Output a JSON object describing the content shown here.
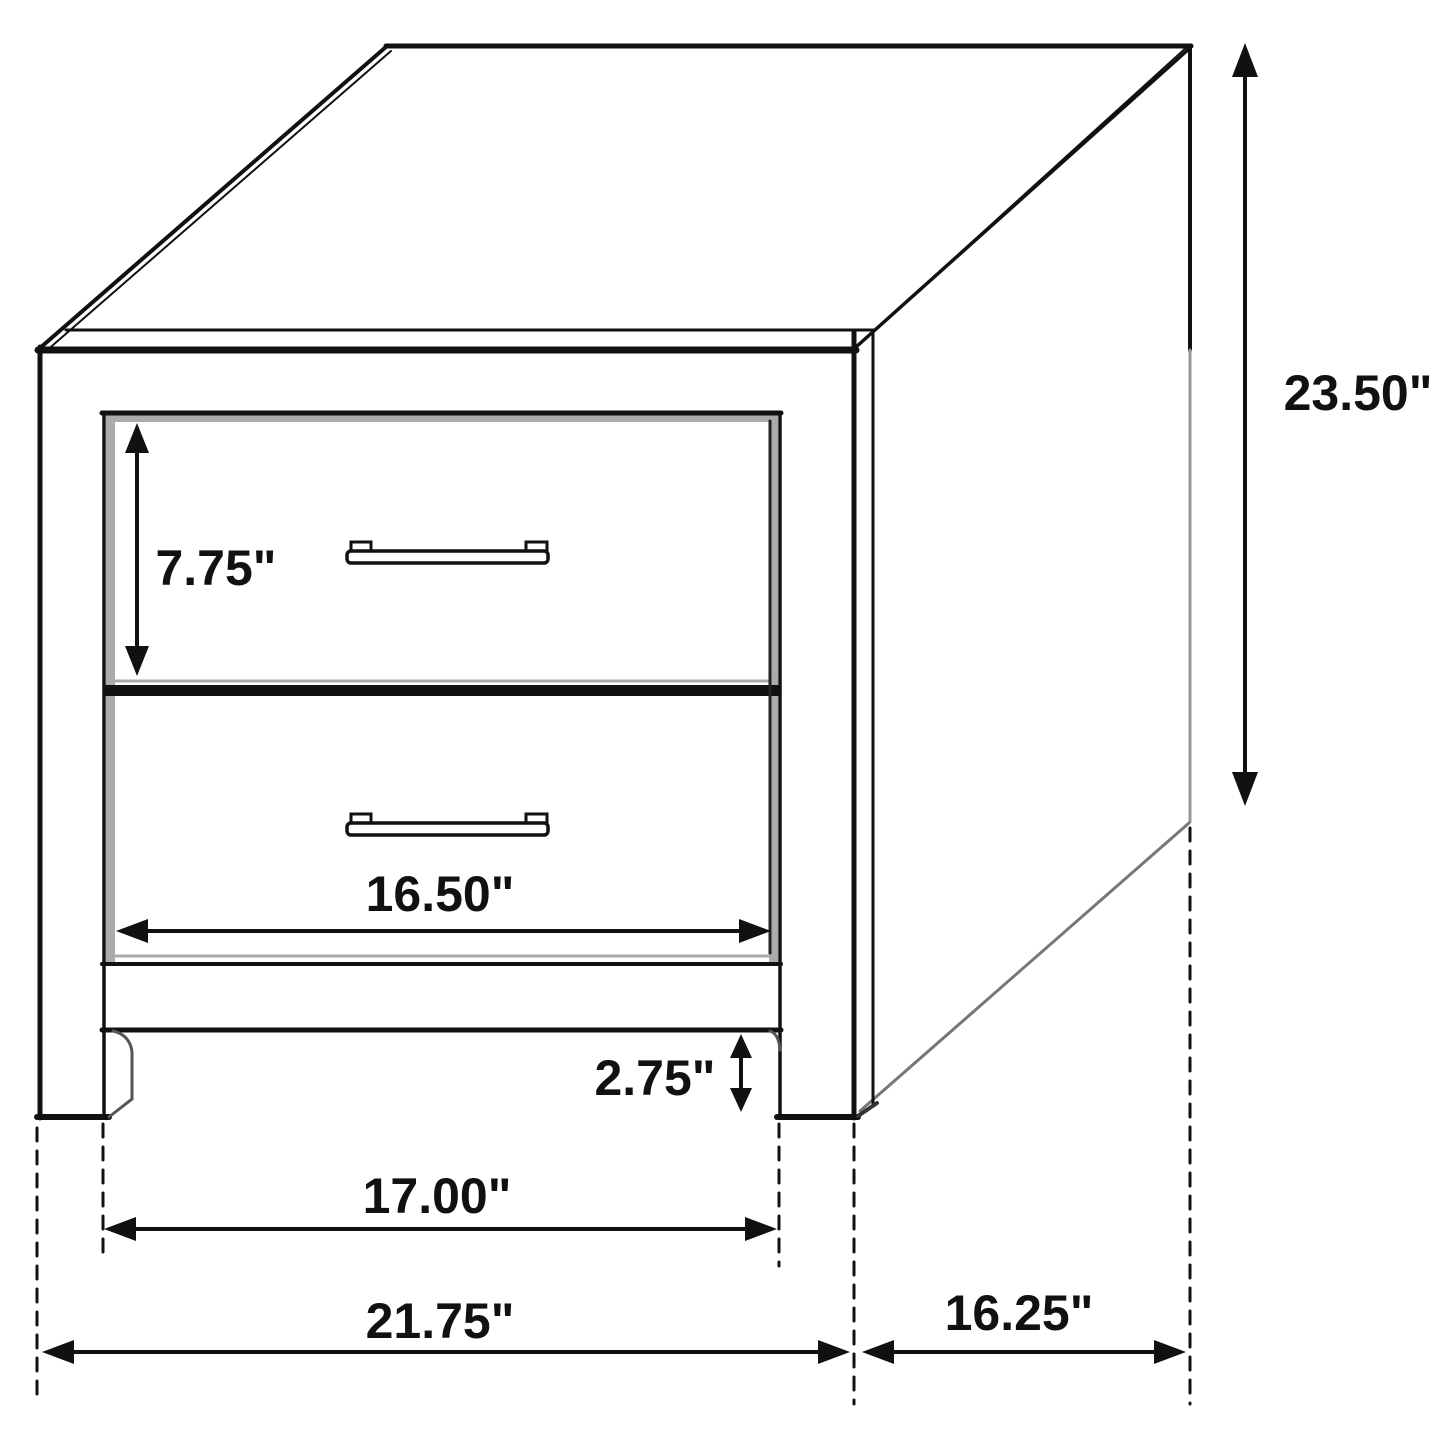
{
  "page": {
    "type": "furniture dimension diagram",
    "subject": "two-drawer nightstand line drawing with measurements",
    "background_color": "#ffffff",
    "line_color": "#111111",
    "shadow_color": "#ababab"
  },
  "dimensions": {
    "overall_height": {
      "label": "23.50\"",
      "value_inches": 23.5,
      "measures": "overall height, right side vertical arrow"
    },
    "top_drawer_height": {
      "label": "7.75\"",
      "value_inches": 7.75,
      "measures": "drawer face height, upper-left vertical arrow"
    },
    "drawer_width": {
      "label": "16.50\"",
      "value_inches": 16.5,
      "measures": "drawer opening width, horizontal arrow on lower drawer"
    },
    "leg_clearance": {
      "label": "2.75\"",
      "value_inches": 2.75,
      "measures": "height of open space under bottom rail"
    },
    "inner_leg_span": {
      "label": "17.00\"",
      "value_inches": 17.0,
      "measures": "span between front legs, inner faces"
    },
    "overall_width": {
      "label": "21.75\"",
      "value_inches": 21.75,
      "measures": "overall front width"
    },
    "side_depth": {
      "label": "16.25\"",
      "value_inches": 16.25,
      "measures": "side depth front-to-back"
    }
  }
}
